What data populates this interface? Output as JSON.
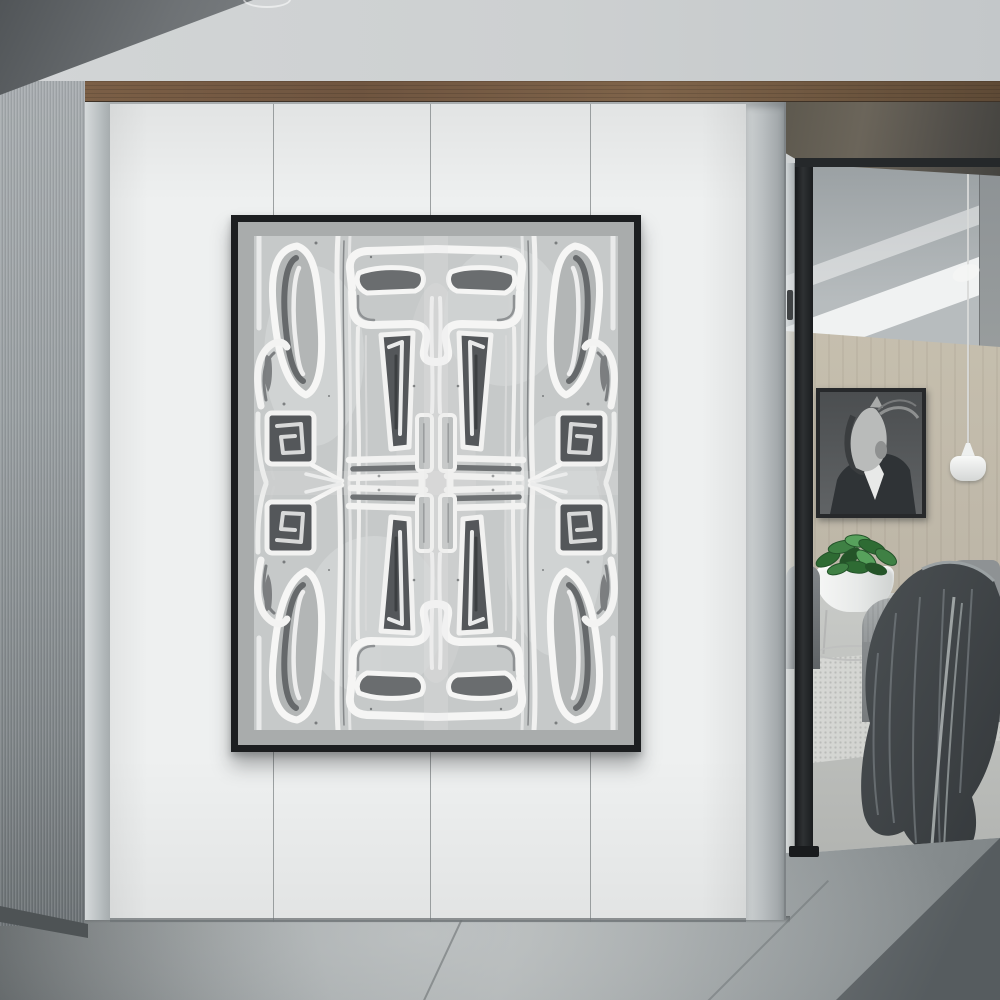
{
  "scene": {
    "type": "interior-photograph",
    "description": "Minimalist hallway: large black-framed abstract artwork on a white paneled wall, brushed-metal gray wall at left, walnut trim band above, and a glass-partition doorway at right opening to a lounge with a grayscale horse-in-suit portrait, white pendant lamp, potted green plant in a round white planter on a wire stand, gray woven armchair with a charcoal throw blanket, textured light rug, and gray concrete tile floor in the foreground.",
    "palette": {
      "ceiling": "#cdd0d1",
      "wood_trim": "#6f5540",
      "metal_wall": "#9aa0a3",
      "white_wall": "#eef0f0",
      "floor": "#a9aeaf",
      "floor_shadow": "#6b7073",
      "room_wall_tan": "#c6bfae",
      "frame_black": "#1c1e20",
      "artwork_mat": "#a9acac",
      "artwork_dark": "#54575a",
      "artwork_light": "#f2f2f1",
      "plant_green": "#3b7a40",
      "blanket_charcoal": "#3f4346"
    },
    "artwork": {
      "style": "hand-painted abstract tribal brushwork, mirrored kaleidoscope symmetry",
      "frame": "thin black gallery frame",
      "mat": "gray",
      "motifs": [
        "elongated paddle shapes",
        "rectangular spirals",
        "comb and chevron marks",
        "flowing white stripes"
      ]
    },
    "room": {
      "wall_art": "grayscale portrait of a horse wearing a suit",
      "furniture": [
        "gray woven armchair with charcoal blanket",
        "dark gray side chair",
        "round white planter on wire stand"
      ],
      "lighting": "white pendant lamp on cord",
      "floor": "light gray floor with woven textured rug"
    }
  }
}
